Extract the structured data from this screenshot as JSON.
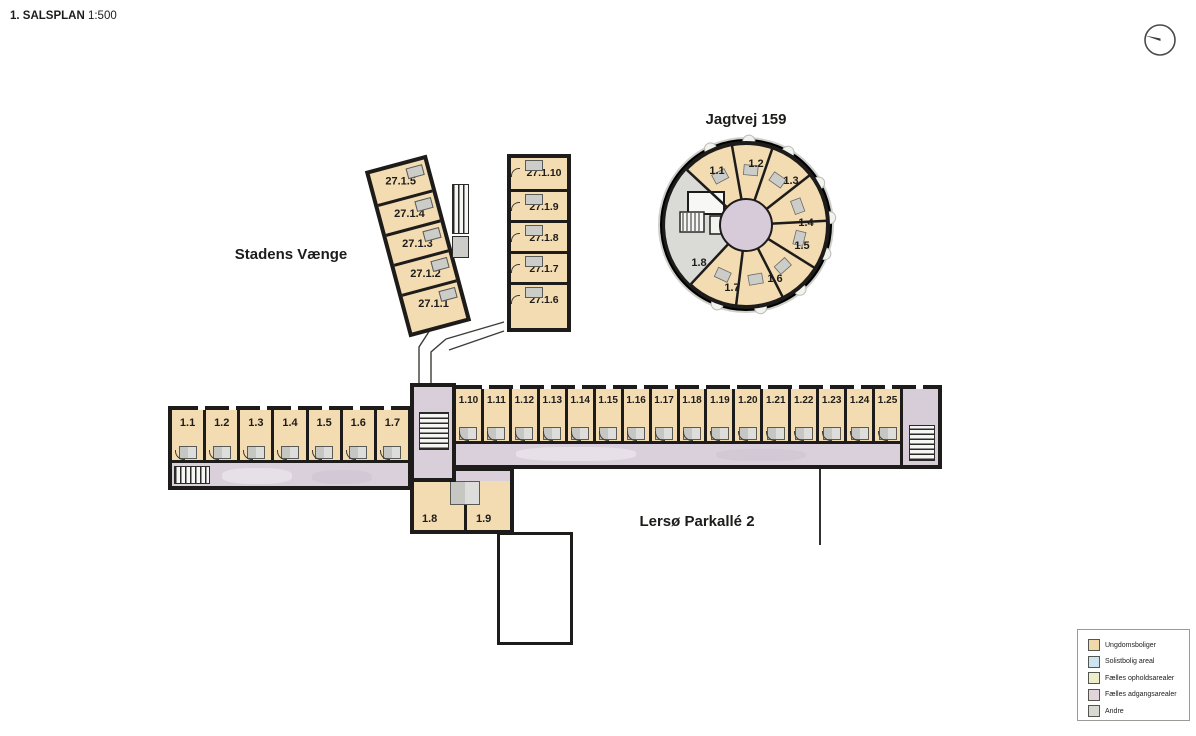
{
  "title": {
    "label": "1. SALSPLAN",
    "scale": "1:500"
  },
  "buildings": {
    "jagtvej": {
      "name": "Jagtvej 159",
      "units": [
        "1.1",
        "1.2",
        "1.3",
        "1.4",
        "1.5",
        "1.6",
        "1.7",
        "1.8"
      ]
    },
    "stadens": {
      "name": "Stadens Vænge",
      "units": [
        "27.1.5",
        "27.1.4",
        "27.1.3",
        "27.1.2",
        "27.1.1"
      ],
      "annex_units": [
        "27.1.10",
        "27.1.9",
        "27.1.8",
        "27.1.7",
        "27.1.6"
      ]
    },
    "lersoe": {
      "name": "Lersø Parkallé 2",
      "west_units": [
        "1.1",
        "1.2",
        "1.3",
        "1.4",
        "1.5",
        "1.6",
        "1.7"
      ],
      "east_units": [
        "1.10",
        "1.11",
        "1.12",
        "1.13",
        "1.14",
        "1.15",
        "1.16",
        "1.17",
        "1.18",
        "1.19",
        "1.20",
        "1.21",
        "1.22",
        "1.23",
        "1.24",
        "1.25"
      ],
      "south_units": [
        "1.8",
        "1.9"
      ]
    }
  },
  "legend": {
    "items": [
      {
        "label": "Ungdomsboliger",
        "color": "#f2d9a9"
      },
      {
        "label": "Solistbolig areal",
        "color": "#cde3ef"
      },
      {
        "label": "Fælles opholdsarealer",
        "color": "#ededca"
      },
      {
        "label": "Fælles adgangsarealer",
        "color": "#e2d4db"
      },
      {
        "label": "Andre",
        "color": "#d9d9d3"
      }
    ]
  },
  "colors": {
    "unit": "#f3dcb2",
    "corridor": "#dad0dc",
    "core": "#d7cad9",
    "service": "#dadad6",
    "wall": "#1d1c1a"
  }
}
